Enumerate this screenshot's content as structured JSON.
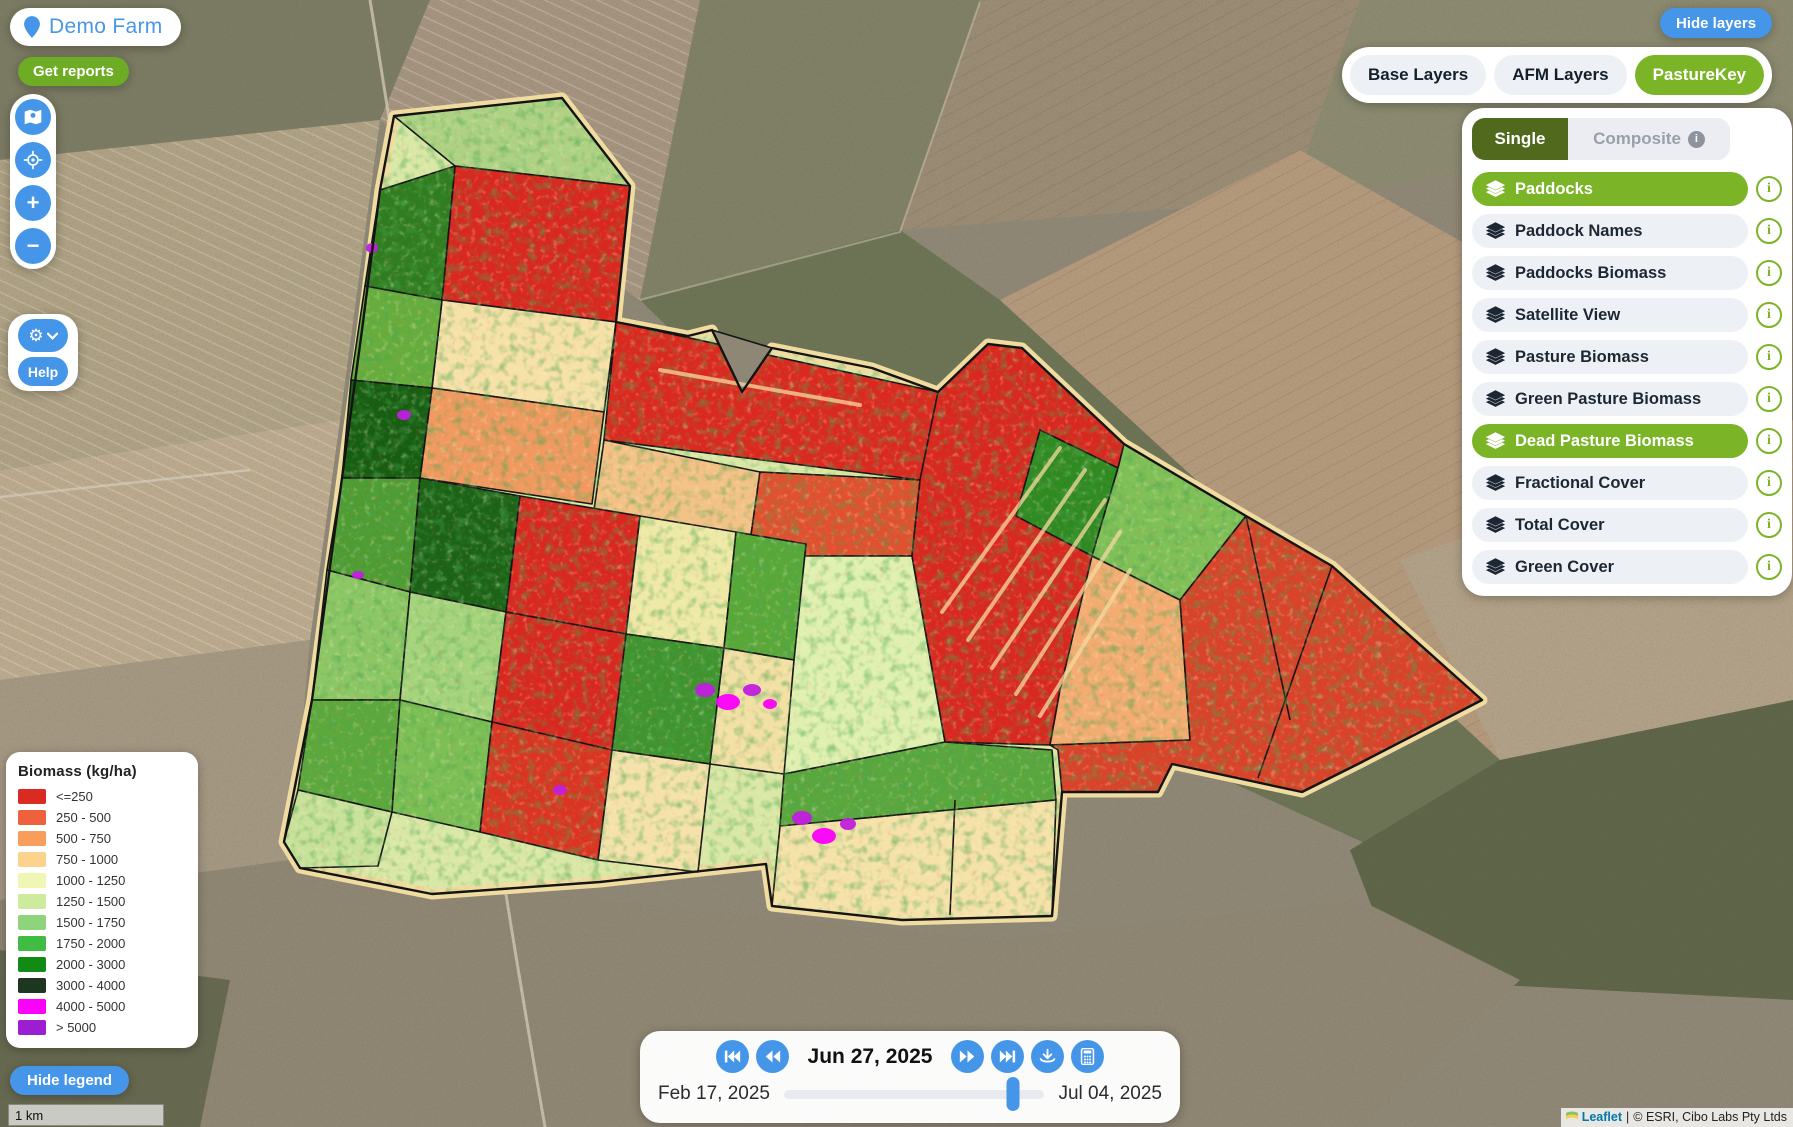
{
  "farm": {
    "name": "Demo Farm"
  },
  "buttons": {
    "get_reports": "Get reports",
    "help": "Help",
    "hide_legend": "Hide legend",
    "hide_layers": "Hide layers",
    "zoom_in_glyph": "+",
    "zoom_out_glyph": "−"
  },
  "icons": {
    "info_glyph": "i"
  },
  "tabs": {
    "items": [
      {
        "label": "Base Layers",
        "active": false
      },
      {
        "label": "AFM Layers",
        "active": false
      },
      {
        "label": "PastureKey",
        "active": true
      }
    ]
  },
  "layer_panel": {
    "single_label": "Single",
    "composite_label": "Composite",
    "layers": [
      {
        "label": "Paddocks",
        "active": true
      },
      {
        "label": "Paddock Names",
        "active": false
      },
      {
        "label": "Paddocks Biomass",
        "active": false
      },
      {
        "label": "Satellite View",
        "active": false
      },
      {
        "label": "Pasture Biomass",
        "active": false
      },
      {
        "label": "Green Pasture Biomass",
        "active": false
      },
      {
        "label": "Dead Pasture Biomass",
        "active": true
      },
      {
        "label": "Fractional Cover",
        "active": false
      },
      {
        "label": "Total Cover",
        "active": false
      },
      {
        "label": "Green Cover",
        "active": false
      }
    ]
  },
  "legend": {
    "title": "Biomass (kg/ha)",
    "items": [
      {
        "label": "<=250",
        "color": "#da2b23"
      },
      {
        "label": "250 - 500",
        "color": "#ee613d"
      },
      {
        "label": "500 - 750",
        "color": "#f99d5d"
      },
      {
        "label": "750 - 1000",
        "color": "#fbd38c"
      },
      {
        "label": "1000 - 1250",
        "color": "#f0f7b2"
      },
      {
        "label": "1250 - 1500",
        "color": "#cdeb9d"
      },
      {
        "label": "1500 - 1750",
        "color": "#8ed47c"
      },
      {
        "label": "1750 - 2000",
        "color": "#3fbc41"
      },
      {
        "label": "2000 - 3000",
        "color": "#128a13"
      },
      {
        "label": "3000 - 4000",
        "color": "#1c3620"
      },
      {
        "label": "4000 - 5000",
        "color": "#fb00fb"
      },
      {
        "label": "> 5000",
        "color": "#9b1fd0"
      }
    ]
  },
  "timeline": {
    "current_date": "Jun 27, 2025",
    "range_start": "Feb 17, 2025",
    "range_end": "Jul 04, 2025",
    "progress_pct": 88
  },
  "scale_bar": {
    "label": "1 km"
  },
  "attribution": {
    "leaflet_label": "Leaflet",
    "separator": "|",
    "text": "© ESRI, Cibo Labs Pty Ltds"
  },
  "colors": {
    "accent_blue": "#4596e8",
    "accent_green": "#7cb428",
    "button_green": "#6dac24",
    "single_dark_green": "#50691d",
    "pill_gray": "#edf0f5"
  }
}
